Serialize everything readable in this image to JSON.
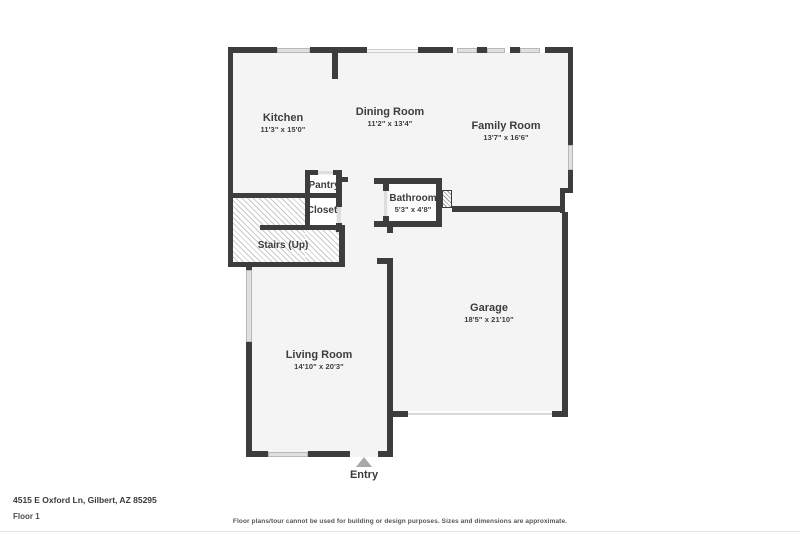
{
  "plan": {
    "rooms": [
      {
        "name": "Kitchen",
        "dims": "11'3\" x 15'0\""
      },
      {
        "name": "Dining Room",
        "dims": "11'2\" x 13'4\""
      },
      {
        "name": "Family Room",
        "dims": "13'7\" x 16'6\""
      },
      {
        "name": "Bathroom",
        "dims": "5'3\" x 4'8\""
      },
      {
        "name": "Garage",
        "dims": "18'5\" x 21'10\""
      },
      {
        "name": "Living Room",
        "dims": "14'10\" x 20'3\""
      },
      {
        "name": "Pantry",
        "dims": ""
      },
      {
        "name": "Closet",
        "dims": ""
      },
      {
        "name": "Stairs (Up)",
        "dims": ""
      }
    ],
    "entry_label": "Entry"
  },
  "footer": {
    "address": "4515 E Oxford Ln, Gilbert, AZ 85295",
    "floor_label": "Floor 1",
    "disclaimer": "Floor plans/tour cannot be used for building or design purposes. Sizes and dimensions are approximate."
  },
  "colors": {
    "wall": "#3d3d3d",
    "room_fill": "#f4f4f4",
    "window": "#e0e0e0",
    "hatch_line": "#c9c9c9",
    "entry_marker": "#a8a8a8",
    "text": "#3d3d3d"
  }
}
